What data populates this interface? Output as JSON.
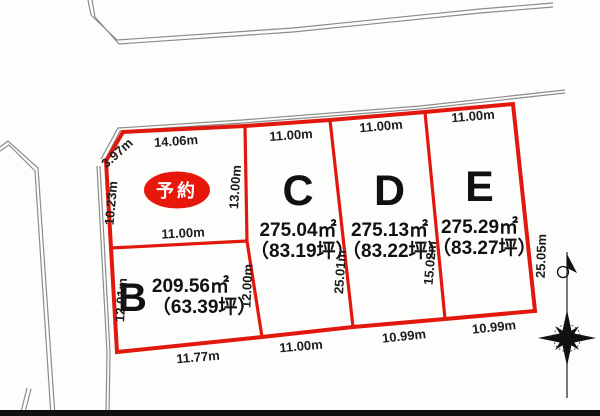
{
  "colors": {
    "parcel_red": "#e2170d",
    "reserved_red": "#e8170b",
    "road_gray": "#8c8c8c",
    "text_ink": "#1c1c1c"
  },
  "lots": {
    "A": {
      "reserved_label": "予約"
    },
    "B": {
      "id": "B",
      "area": "209.56㎡",
      "tsubo": "（63.39坪）"
    },
    "C": {
      "id": "C",
      "area": "275.04㎡",
      "tsubo": "（83.19坪）"
    },
    "D": {
      "id": "D",
      "area": "275.13㎡",
      "tsubo": "（83.22坪）"
    },
    "E": {
      "id": "E",
      "area": "275.29㎡",
      "tsubo": "（83.27坪）"
    }
  },
  "dimension_labels": [
    {
      "text": "14.06m",
      "x": 176,
      "y": 141,
      "rot": -4
    },
    {
      "text": "3.97m",
      "x": 117,
      "y": 153,
      "rot": -42
    },
    {
      "text": "10.23m",
      "x": 111,
      "y": 203,
      "rot": -85
    },
    {
      "text": "13.00m",
      "x": 235,
      "y": 187,
      "rot": -86
    },
    {
      "text": "11.00m",
      "x": 183,
      "y": 233,
      "rot": -3
    },
    {
      "text": "12.01m",
      "x": 121,
      "y": 300,
      "rot": -86
    },
    {
      "text": "12.00m",
      "x": 247,
      "y": 286,
      "rot": -87
    },
    {
      "text": "11.77m",
      "x": 198,
      "y": 357,
      "rot": -5
    },
    {
      "text": "11.00m",
      "x": 291,
      "y": 135,
      "rot": -4
    },
    {
      "text": "11.00m",
      "x": 301,
      "y": 346,
      "rot": -5
    },
    {
      "text": "25.01m",
      "x": 340,
      "y": 272,
      "rot": -86
    },
    {
      "text": "11.00m",
      "x": 381,
      "y": 126,
      "rot": -5
    },
    {
      "text": "10.99m",
      "x": 404,
      "y": 336,
      "rot": -6
    },
    {
      "text": "15.02m",
      "x": 430,
      "y": 263,
      "rot": -85
    },
    {
      "text": "11.00m",
      "x": 473,
      "y": 116,
      "rot": -5
    },
    {
      "text": "10.99m",
      "x": 494,
      "y": 327,
      "rot": -6
    },
    {
      "text": "25.05m",
      "x": 541,
      "y": 256,
      "rot": -88
    }
  ],
  "icons": {
    "compass": "compass-rose-north-arrow"
  }
}
